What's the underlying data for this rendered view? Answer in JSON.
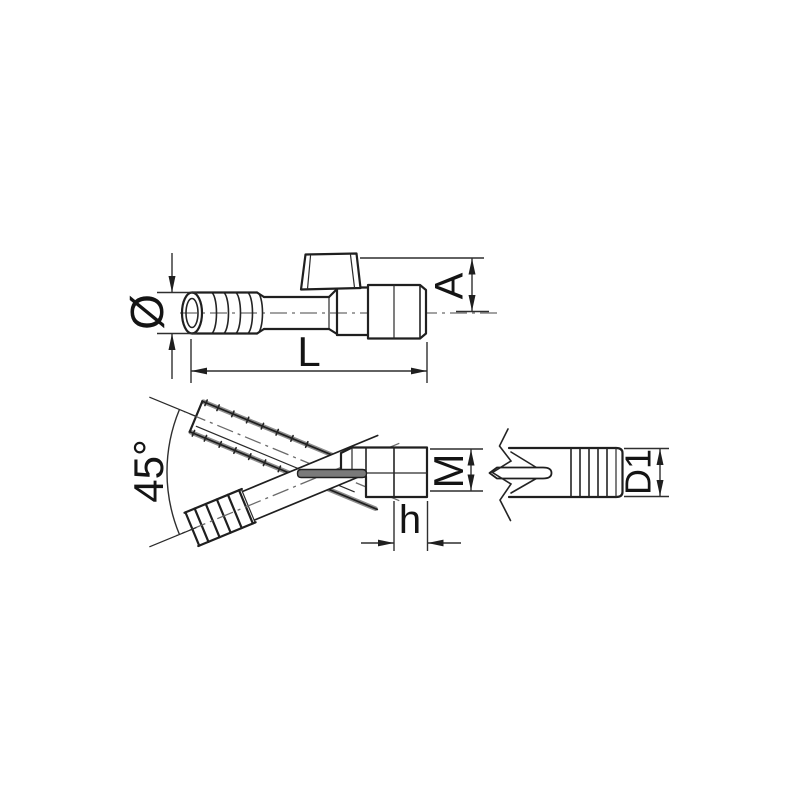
{
  "page": {
    "background": "#ffffff",
    "line_color": "#1f1f1f",
    "centerline_color": "#6a6a6a",
    "shading_color": "#8d8d8d"
  },
  "labels": {
    "hose_diameter": "Ø",
    "outlet_height": "A",
    "overall_length": "L",
    "branch_angle": "45°",
    "thread_size": "M",
    "thread_length": "h",
    "spout_diameter": "D1"
  }
}
